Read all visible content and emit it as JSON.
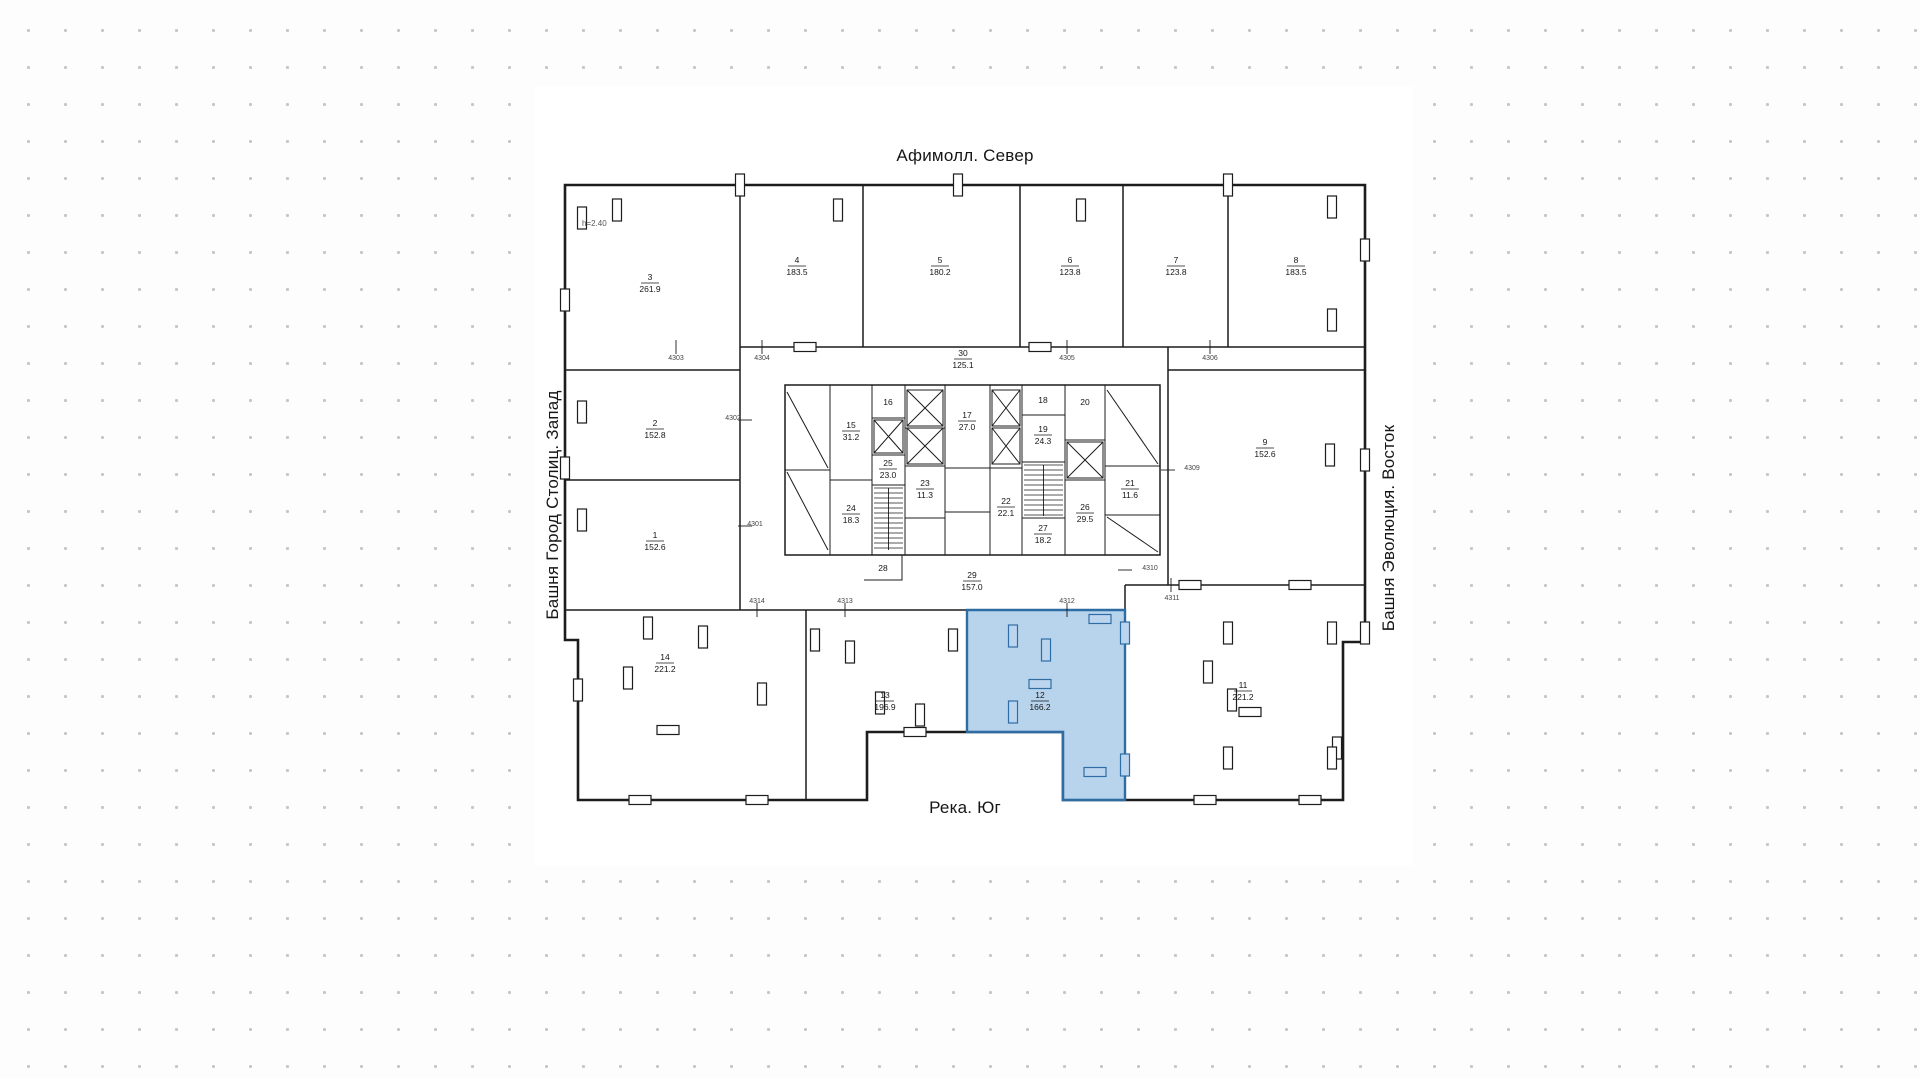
{
  "plan": {
    "title_north": "Афимолл. Север",
    "label_west": "Башня Город Столиц. Запад",
    "label_east": "Башня Эволюция. Восток",
    "label_south": "Река. Юг",
    "ceiling_note": "h=2.40",
    "highlighted_room": "12",
    "colors": {
      "wall": "#1c1c1c",
      "paper": "#ffffff",
      "dot": "#c6c6c6",
      "highlight_fill": "#a6c9e9",
      "highlight_stroke": "#2e6da4",
      "highlight_furniture_fill": "#bcd5ee"
    },
    "rooms": [
      {
        "n": "1",
        "area": "152.6",
        "x": 655,
        "y": 540
      },
      {
        "n": "2",
        "area": "152.8",
        "x": 655,
        "y": 428
      },
      {
        "n": "3",
        "area": "261.9",
        "x": 650,
        "y": 282
      },
      {
        "n": "4",
        "area": "183.5",
        "x": 797,
        "y": 265
      },
      {
        "n": "5",
        "area": "180.2",
        "x": 940,
        "y": 265
      },
      {
        "n": "6",
        "area": "123.8",
        "x": 1070,
        "y": 265
      },
      {
        "n": "7",
        "area": "123.8",
        "x": 1176,
        "y": 265
      },
      {
        "n": "8",
        "area": "183.5",
        "x": 1296,
        "y": 265
      },
      {
        "n": "9",
        "area": "152.6",
        "x": 1265,
        "y": 447
      },
      {
        "n": "11",
        "area": "221.2",
        "x": 1243,
        "y": 690
      },
      {
        "n": "12",
        "area": "166.2",
        "x": 1040,
        "y": 700,
        "highlight": true
      },
      {
        "n": "13",
        "area": "196.9",
        "x": 885,
        "y": 700
      },
      {
        "n": "14",
        "area": "221.2",
        "x": 665,
        "y": 662
      },
      {
        "n": "15",
        "area": "31.2",
        "x": 851,
        "y": 430
      },
      {
        "n": "16",
        "area": null,
        "x": 888,
        "y": 403
      },
      {
        "n": "17",
        "area": "27.0",
        "x": 967,
        "y": 420
      },
      {
        "n": "18",
        "area": null,
        "x": 1043,
        "y": 401
      },
      {
        "n": "19",
        "area": "24.3",
        "x": 1043,
        "y": 434
      },
      {
        "n": "20",
        "area": null,
        "x": 1085,
        "y": 403
      },
      {
        "n": "21",
        "area": "11.6",
        "x": 1130,
        "y": 488
      },
      {
        "n": "22",
        "area": "22.1",
        "x": 1006,
        "y": 506
      },
      {
        "n": "23",
        "area": "11.3",
        "x": 925,
        "y": 488
      },
      {
        "n": "24",
        "area": "18.3",
        "x": 851,
        "y": 513
      },
      {
        "n": "25",
        "area": "23.0",
        "x": 888,
        "y": 468
      },
      {
        "n": "26",
        "area": "29.5",
        "x": 1085,
        "y": 512
      },
      {
        "n": "27",
        "area": "18.2",
        "x": 1043,
        "y": 533
      },
      {
        "n": "28",
        "area": null,
        "x": 883,
        "y": 569
      },
      {
        "n": "29",
        "area": "157.0",
        "x": 972,
        "y": 580
      },
      {
        "n": "30",
        "area": "125.1",
        "x": 963,
        "y": 358
      }
    ],
    "grid_tags": [
      {
        "t": "4303",
        "x": 676,
        "y": 360
      },
      {
        "t": "4304",
        "x": 762,
        "y": 360
      },
      {
        "t": "4305",
        "x": 1067,
        "y": 360
      },
      {
        "t": "4306",
        "x": 1210,
        "y": 360
      },
      {
        "t": "4302",
        "x": 733,
        "y": 420
      },
      {
        "t": "4301",
        "x": 755,
        "y": 526
      },
      {
        "t": "4309",
        "x": 1192,
        "y": 470
      },
      {
        "t": "4310",
        "x": 1150,
        "y": 570
      },
      {
        "t": "4311",
        "x": 1172,
        "y": 600
      },
      {
        "t": "4312",
        "x": 1067,
        "y": 603
      },
      {
        "t": "4313",
        "x": 845,
        "y": 603
      },
      {
        "t": "4314",
        "x": 757,
        "y": 603
      }
    ]
  }
}
